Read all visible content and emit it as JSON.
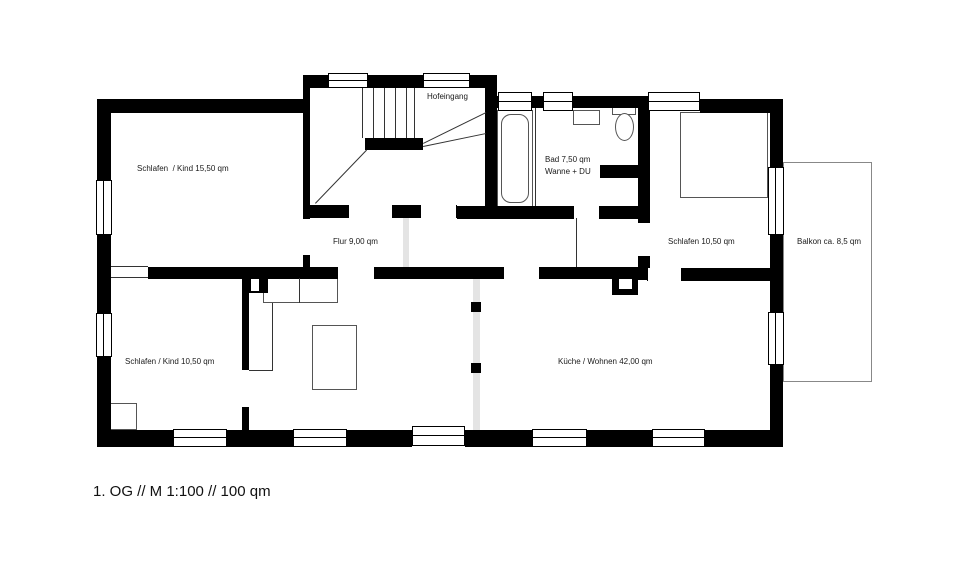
{
  "caption": {
    "text": "1. OG // M 1:100 // 100 qm"
  },
  "plan": {
    "canvas": {
      "w": 960,
      "h": 572
    },
    "walls": [
      [
        97,
        99,
        14,
        81
      ],
      [
        97,
        235,
        14,
        78
      ],
      [
        97,
        357,
        14,
        90
      ],
      [
        97,
        99,
        213,
        14
      ],
      [
        303,
        75,
        27,
        13
      ],
      [
        367,
        75,
        56,
        13
      ],
      [
        470,
        75,
        27,
        13
      ],
      [
        303,
        88,
        7,
        130
      ],
      [
        303,
        256,
        7,
        11
      ],
      [
        485,
        88,
        12,
        118
      ],
      [
        490,
        96,
        8,
        12
      ],
      [
        532,
        96,
        11,
        12
      ],
      [
        573,
        96,
        80,
        12
      ],
      [
        640,
        99,
        8,
        14
      ],
      [
        700,
        99,
        83,
        14
      ],
      [
        770,
        99,
        13,
        68
      ],
      [
        770,
        235,
        13,
        77
      ],
      [
        770,
        365,
        13,
        82
      ],
      [
        97,
        430,
        76,
        17
      ],
      [
        227,
        430,
        66,
        17
      ],
      [
        347,
        430,
        65,
        17
      ],
      [
        465,
        430,
        67,
        17
      ],
      [
        587,
        430,
        65,
        17
      ],
      [
        705,
        430,
        78,
        17
      ],
      [
        303,
        205,
        45,
        13
      ],
      [
        393,
        205,
        27,
        13
      ],
      [
        457,
        206,
        116,
        13
      ],
      [
        600,
        206,
        38,
        13
      ],
      [
        600,
        165,
        40,
        13
      ],
      [
        638,
        108,
        12,
        114
      ],
      [
        638,
        257,
        12,
        23
      ],
      [
        148,
        267,
        189,
        12
      ],
      [
        375,
        267,
        128,
        12
      ],
      [
        540,
        267,
        98,
        12
      ],
      [
        682,
        268,
        101,
        13
      ],
      [
        612,
        273,
        26,
        22
      ],
      [
        242,
        277,
        7,
        93
      ],
      [
        249,
        277,
        19,
        16
      ],
      [
        242,
        407,
        7,
        23
      ],
      [
        365,
        138,
        58,
        12
      ]
    ],
    "white_holes": [
      [
        619,
        279,
        13,
        10
      ],
      [
        251,
        279,
        8,
        12
      ]
    ],
    "windows": [
      [
        96,
        180,
        16,
        55,
        "v"
      ],
      [
        96,
        313,
        16,
        44,
        "v"
      ],
      [
        328,
        73,
        40,
        15,
        "h"
      ],
      [
        423,
        73,
        47,
        15,
        "h"
      ],
      [
        498,
        92,
        34,
        19,
        "h"
      ],
      [
        543,
        92,
        30,
        19,
        "h"
      ],
      [
        648,
        92,
        52,
        19,
        "h"
      ],
      [
        768,
        167,
        16,
        68,
        "v"
      ],
      [
        768,
        312,
        16,
        53,
        "v"
      ],
      [
        173,
        429,
        54,
        18,
        "h"
      ],
      [
        293,
        429,
        54,
        18,
        "h"
      ],
      [
        412,
        426,
        53,
        20,
        "h"
      ],
      [
        532,
        429,
        55,
        18,
        "h"
      ],
      [
        652,
        429,
        53,
        18,
        "h"
      ]
    ],
    "door_gaps": [
      [
        303,
        218,
        7,
        38,
        "v"
      ],
      [
        348,
        205,
        45,
        13,
        "h"
      ],
      [
        420,
        205,
        37,
        13,
        "h"
      ],
      [
        573,
        206,
        27,
        13,
        "h"
      ],
      [
        337,
        267,
        38,
        12,
        "h"
      ],
      [
        503,
        267,
        37,
        12,
        "h"
      ],
      [
        647,
        268,
        35,
        13,
        "h"
      ],
      [
        638,
        222,
        12,
        35,
        "v"
      ]
    ],
    "strips": [
      [
        403,
        215,
        6,
        52
      ],
      [
        473,
        278,
        7,
        152
      ]
    ],
    "squares": [
      [
        471,
        302,
        10,
        10
      ],
      [
        471,
        363,
        10,
        10
      ]
    ],
    "furniture": [
      {
        "name": "wardrobe",
        "x": 263,
        "y": 278,
        "w": 75,
        "h": 25,
        "shape": "rect"
      },
      {
        "name": "table",
        "x": 312,
        "y": 325,
        "w": 45,
        "h": 65,
        "shape": "rect"
      },
      {
        "name": "corner-cabinet",
        "x": 110,
        "y": 403,
        "w": 27,
        "h": 27,
        "shape": "rect"
      },
      {
        "name": "bed",
        "x": 680,
        "y": 112,
        "w": 88,
        "h": 86,
        "shape": "rect"
      },
      {
        "name": "balcony",
        "x": 783,
        "y": 162,
        "w": 89,
        "h": 220,
        "shape": "balcony"
      },
      {
        "name": "bathtub",
        "x": 497,
        "y": 110,
        "w": 36,
        "h": 97,
        "shape": "rect"
      },
      {
        "name": "bathtub-inner",
        "x": 501,
        "y": 114,
        "w": 28,
        "h": 89,
        "shape": "round"
      },
      {
        "name": "washbasin",
        "x": 573,
        "y": 110,
        "w": 27,
        "h": 15,
        "shape": "rect"
      },
      {
        "name": "wc-tank",
        "x": 612,
        "y": 106,
        "w": 24,
        "h": 9,
        "shape": "rect"
      },
      {
        "name": "wc-bowl",
        "x": 615,
        "y": 113,
        "w": 19,
        "h": 28,
        "shape": "ellipse"
      }
    ],
    "lines": [
      [
        363,
        88,
        363,
        138
      ],
      [
        374,
        88,
        374,
        138
      ],
      [
        385,
        88,
        385,
        138
      ],
      [
        396,
        88,
        396,
        138
      ],
      [
        407,
        88,
        407,
        138
      ],
      [
        415,
        88,
        415,
        138
      ],
      [
        315,
        203,
        366,
        150
      ],
      [
        423,
        143,
        486,
        112
      ],
      [
        423,
        146,
        486,
        133
      ],
      [
        111,
        266,
        148,
        266
      ],
      [
        111,
        277,
        148,
        277
      ],
      [
        577,
        218,
        577,
        267
      ],
      [
        273,
        303,
        273,
        370
      ],
      [
        249,
        370,
        273,
        370
      ],
      [
        536,
        108,
        536,
        206
      ],
      [
        300,
        278,
        300,
        303
      ]
    ],
    "labels": [
      {
        "id": "schlafen-kind-1",
        "text": "Schlafen  / Kind 15,50 qm",
        "x": 137,
        "y": 164
      },
      {
        "id": "hofeingang",
        "text": "Hofeingang",
        "x": 427,
        "y": 92
      },
      {
        "id": "bad-line1",
        "text": "Bad 7,50 qm",
        "x": 545,
        "y": 155
      },
      {
        "id": "bad-line2",
        "text": "Wanne + DU",
        "x": 545,
        "y": 167
      },
      {
        "id": "flur",
        "text": "Flur 9,00 qm",
        "x": 333,
        "y": 237
      },
      {
        "id": "schlafen-2",
        "text": "Schlafen 10,50 qm",
        "x": 668,
        "y": 237
      },
      {
        "id": "balkon",
        "text": "Balkon ca. 8,5 qm",
        "x": 797,
        "y": 237
      },
      {
        "id": "schlafen-kind-2",
        "text": "Schlafen / Kind 10,50 qm",
        "x": 125,
        "y": 357
      },
      {
        "id": "kueche",
        "text": "Küche / Wohnen 42,00 qm",
        "x": 558,
        "y": 357
      }
    ]
  }
}
